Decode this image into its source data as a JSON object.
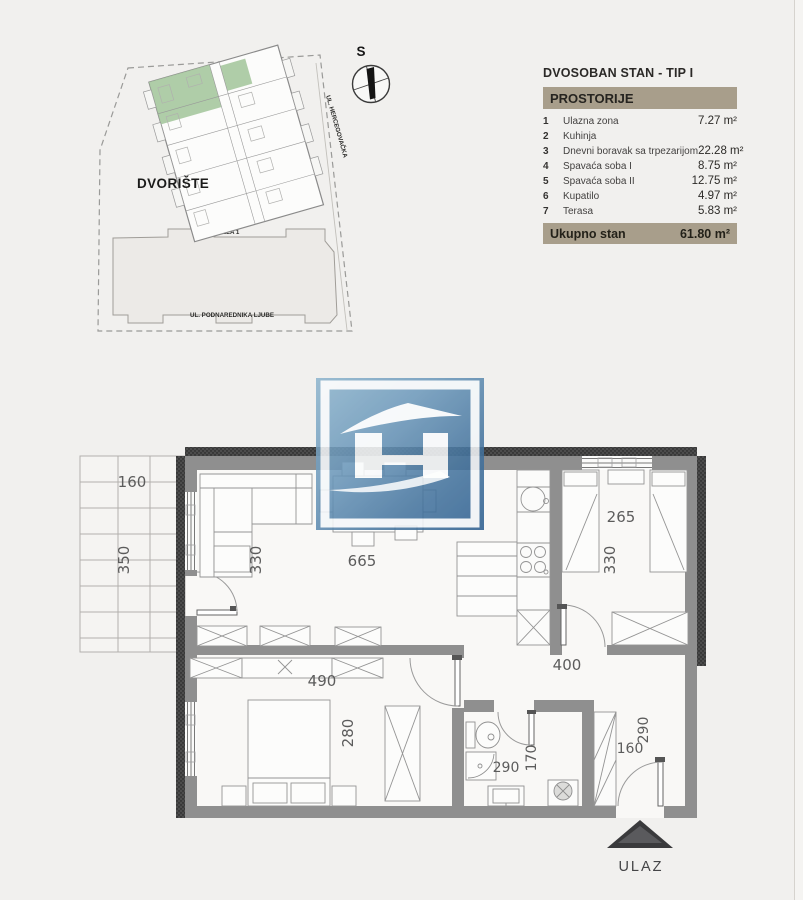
{
  "site_plan": {
    "courtyard_label": "DVORIŠTE",
    "building_label": "LAMELA 1",
    "street_bottom_label": "UL. PODNAREDNIKA LJUBE",
    "street_right_label": "UL. HERCEGOVAČKA",
    "compass_north_label": "S",
    "highlighted_unit_color": "#a6c89e"
  },
  "info_table": {
    "title": "DVOSOBAN STAN - TIP I",
    "header_label": "PROSTORIJE",
    "accent_color": "#a89e8b",
    "rows": [
      {
        "num": "1",
        "name": "Ulazna zona",
        "area": "7.27 m²"
      },
      {
        "num": "2",
        "name": "Kuhinja",
        "area": ""
      },
      {
        "num": "3",
        "name": "Dnevni boravak sa trpezarijom",
        "area": "22.28 m²"
      },
      {
        "num": "4",
        "name": "Spavaća soba I",
        "area": "8.75 m²"
      },
      {
        "num": "5",
        "name": "Spavaća soba II",
        "area": "12.75 m²"
      },
      {
        "num": "6",
        "name": "Kupatilo",
        "area": "4.97 m²"
      },
      {
        "num": "7",
        "name": "Terasa",
        "area": "5.83 m²"
      }
    ],
    "total_label": "Ukupno stan",
    "total_value": "61.80 m²"
  },
  "floor_plan": {
    "entrance_label": "ULAZ",
    "dimensions": {
      "terrace_width": "160",
      "terrace_depth": "350",
      "living_depth": "330",
      "living_width": "665",
      "bedroom1_width": "265",
      "bedroom1_depth": "330",
      "hall_width": "400",
      "bedroom2_width": "490",
      "bedroom2_depth": "280",
      "bathroom_width": "290",
      "bathroom_depth": "170",
      "entry_width": "160",
      "entry_depth": "290"
    }
  }
}
